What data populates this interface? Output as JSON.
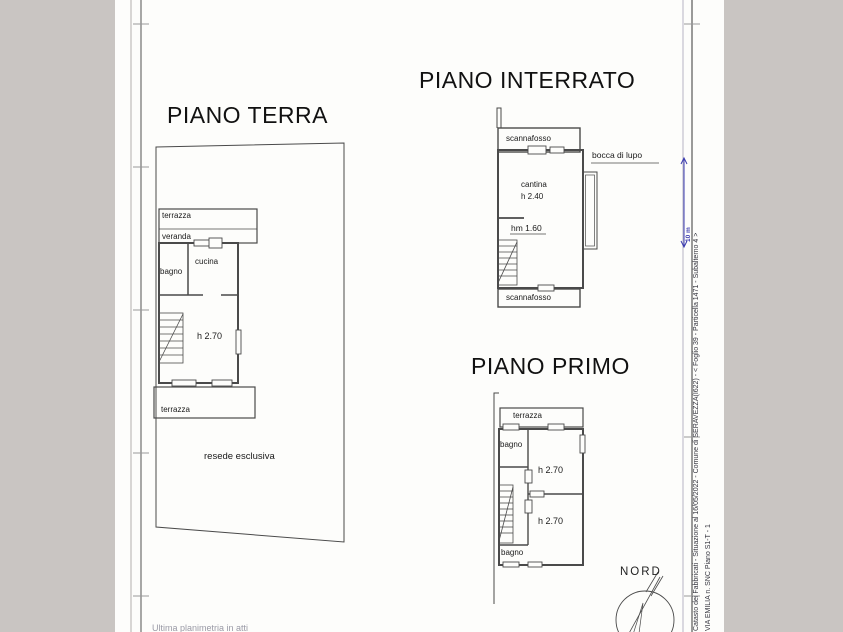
{
  "colors": {
    "canvas": "#c9c5c2",
    "paper": "#fdfdfb",
    "line": "#4a4a4a",
    "accent_blue": "#3b3baf"
  },
  "headings": {
    "piano_terra": "PIANO TERRA",
    "piano_interrato": "PIANO INTERRATO",
    "piano_primo": "PIANO PRIMO"
  },
  "piano_terra": {
    "terrazza_top": "terrazza",
    "veranda": "veranda",
    "bagno": "bagno",
    "cucina": "cucina",
    "room_height": "h 2.70",
    "terrazza_bottom": "terrazza",
    "resede": "resede esclusiva"
  },
  "piano_interrato": {
    "scannafosso_top": "scannafosso",
    "cantina": "cantina",
    "cantina_height": "h 2.40",
    "passage_height": "hm 1.60",
    "bocca_di_lupo": "bocca di lupo",
    "scannafosso_bottom": "scannafosso"
  },
  "piano_primo": {
    "terrazza": "terrazza",
    "bagno_top": "bagno",
    "room1_height": "h 2.70",
    "room2_height": "h 2.70",
    "bagno_bottom": "bagno"
  },
  "compass": {
    "label": "NORD"
  },
  "margin": {
    "catasto_line": "Catasto dei Fabbricati - Situazione al 16/05/2022 - Comune di SERAVEZZA(I622) - < Foglio 39 - Particella 1471 - Subalterno 4 >",
    "address_line": "VIA EMILIA n. SNC Piano S1-T - 1",
    "scale_label": "10 m"
  },
  "footer": {
    "note": "Ultima planimetria in atti"
  }
}
